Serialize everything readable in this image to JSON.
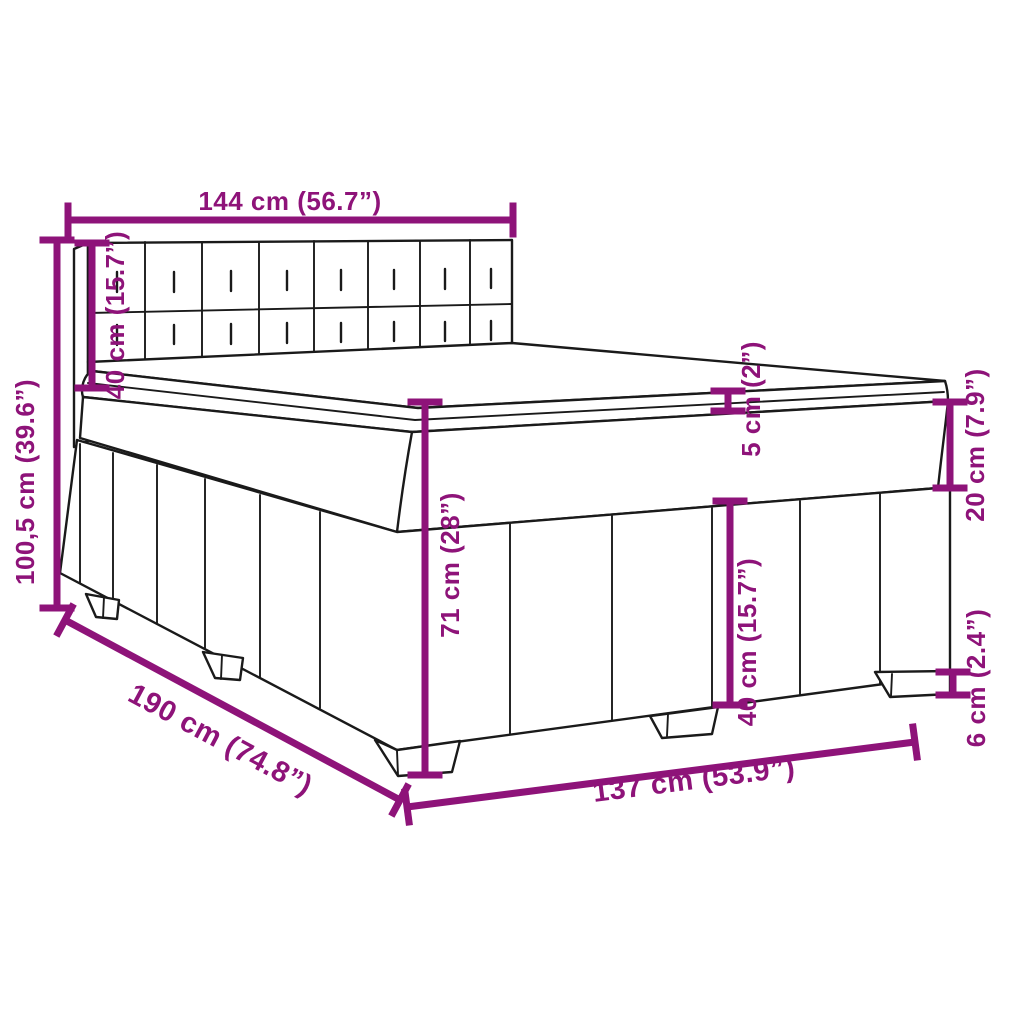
{
  "image": {
    "type": "technical-dimension-diagram",
    "subject": "Box spring bed with tufted headboard and mattress"
  },
  "colors": {
    "dimension_annotation": "#8E1379",
    "outline": "#1A1A1A",
    "background": "#FFFFFF"
  },
  "dimensions": {
    "headboard_width": {
      "cm": "144",
      "inches": "56.7",
      "label": "144 cm (56.7”)"
    },
    "total_height": {
      "cm": "100,5",
      "inches": "39.6",
      "label": "100,5 cm (39.6”)"
    },
    "headboard_height": {
      "cm": "40",
      "inches": "15.7",
      "label": "40 cm (15.7”)"
    },
    "mattress_top": {
      "cm": "5",
      "inches": "2",
      "label": "5 cm (2”)"
    },
    "mattress_box": {
      "cm": "20",
      "inches": "7.9",
      "label": "20 cm (7.9”)"
    },
    "platform_height": {
      "cm": "71",
      "inches": "28",
      "label": "71 cm (28”)"
    },
    "skirt_height": {
      "cm": "40",
      "inches": "15.7",
      "label": "40 cm (15.7”)"
    },
    "leg_height": {
      "cm": "6",
      "inches": "2.4",
      "label": "6 cm (2.4”)"
    },
    "bed_length": {
      "cm": "190",
      "inches": "74.8",
      "label": "190 cm (74.8”)"
    },
    "bed_width": {
      "cm": "137",
      "inches": "53.9",
      "label": "137 cm (53.9”)"
    }
  }
}
